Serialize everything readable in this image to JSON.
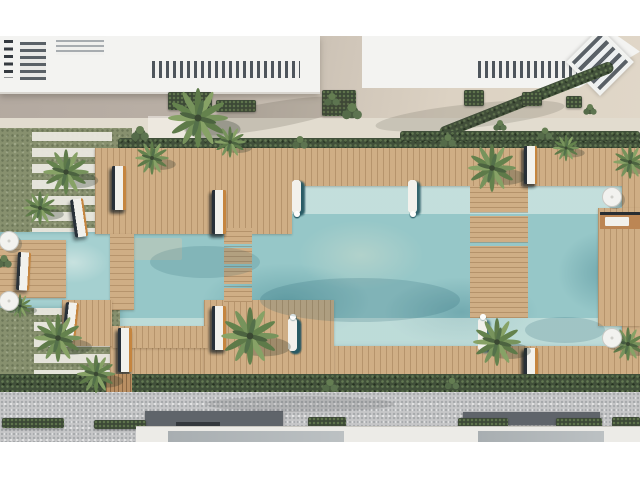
{
  "meta": {
    "description": "Top-down aerial 3D rendering of a resort courtyard: a large turquoise swimming pool framed by timber sun decks and bridges, rows of white sun loungers on the decks and in the shallow water ledges, day beds along the right deck, white umbrellas, palm trees and hedges, with white apartment roof terraces at the top and a paved street with buildings at the bottom.",
    "scene_label": "Resort pool aerial render",
    "view": "top-down"
  },
  "palette": {
    "page_bg": "#ffffff",
    "roof_white": "#f3f3f1",
    "terrace_taupe": "#b5aba1",
    "path_beige": "#ddd3c4",
    "walkway_light": "#e2dccf",
    "lawn_green": "#87906e",
    "hedge_green": "#41503a",
    "palm_green": "#6d8a54",
    "deck_wood": "#cfae85",
    "wood_orange": "#c5853f",
    "pool_base": "#96c7c8",
    "pool_light": "#b7d8d3",
    "pool_deep": "#5d9aa5",
    "lounger_white": "#f2f1ec",
    "lounger_shadow": "#39434d",
    "pavement_gray": "#c6c7c8",
    "facade_white": "#ecebe7",
    "glass_gray": "#aab0b3",
    "dark_roof": "#5f646a"
  },
  "furniture": {
    "lounger_groups": {
      "upper_left_front": 4,
      "upper_left_back": 4,
      "upper_left_pair": 2,
      "jetty_pair": 2,
      "lower_left_pair": 2,
      "lower_left_front": 4,
      "lower_peninsula": 4,
      "right_top": 4,
      "right_bottom": 6,
      "daybeds": 5,
      "water_top_left": 8,
      "water_top_right": 5,
      "water_bottom_left": 13,
      "water_bottom_right": 3
    },
    "umbrella_count": 4,
    "palm_tree_count": 14
  }
}
